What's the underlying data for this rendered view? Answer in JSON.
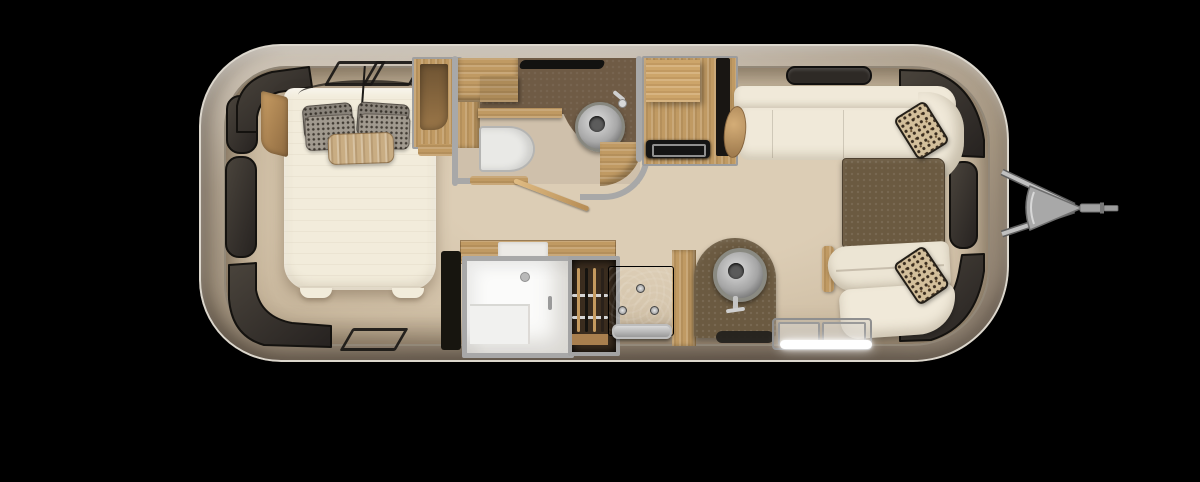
{
  "scene": {
    "type": "travel-trailer-floor-plan",
    "view": "top-down",
    "areas": [
      {
        "id": "bedroom",
        "items": [
          "bed",
          "gray-pillows",
          "tan-bolster-pillow",
          "corner-shelf",
          "wardrobe",
          "roof-vents",
          "reading-light-cord"
        ]
      },
      {
        "id": "bathroom",
        "items": [
          "toilet",
          "round-sink",
          "faucet",
          "vanity-counter",
          "cabinets",
          "swing-door",
          "vent"
        ]
      },
      {
        "id": "galley",
        "items": [
          "shower",
          "hanging-wardrobe",
          "stove",
          "counter-arch",
          "round-sink",
          "faucet",
          "floor-mat",
          "entry-step",
          "step-light"
        ]
      },
      {
        "id": "lounge",
        "items": [
          "sofa",
          "corner-cushion",
          "bolster",
          "dinette-table",
          "lounge-chair",
          "accent-pillows",
          "ceiling-vent"
        ]
      },
      {
        "id": "exterior",
        "items": [
          "aluminum-shell",
          "wraparound-windows",
          "a-frame-hitch",
          "tongue-coupler"
        ]
      }
    ]
  },
  "colors": {
    "background": "#000000",
    "shellLight": "#d3cabd",
    "shellMid": "#b3a592",
    "shellDark": "#8f8171",
    "shellRim": "#dcd7cd",
    "floorLight": "#dccdb5",
    "floorMid": "#cdbca2",
    "floorDark": "#b8a78d",
    "wallGray": "#a8a8a8",
    "windowDark": "#39332c",
    "windowEdge": "#14120f",
    "wood": "#c09a63",
    "woodDark": "#8e6a40",
    "brownCounter": "#6b5a41",
    "brownBath": "#6f5b45",
    "mattress": "#f2ecdb",
    "sofaWhite": "#f0e9d9",
    "pureWhite": "#fbfbfa",
    "applianceBlack": "#141414",
    "steelLight": "#cfcfcf",
    "steelDark": "#8a8a8a",
    "pillowGray": "#a19a8f",
    "pillowDotColor": "#423c34",
    "pillowTan": "#c9ad83",
    "patternBase": "#d3bf9b",
    "patternDot": "#3a2d1f",
    "ledWhite": "#ffffff",
    "hitchGray": "#b3b3b3",
    "ventDark": "#2e2a26"
  }
}
